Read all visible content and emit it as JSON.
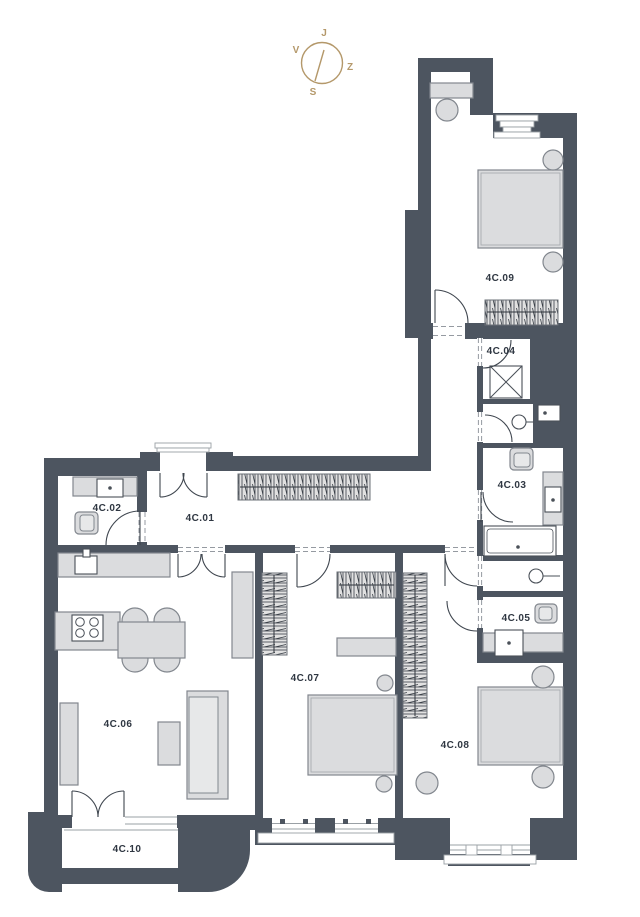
{
  "page": {
    "background": "#ffffff"
  },
  "compass": {
    "top": "J",
    "right": "Z",
    "bottom": "S",
    "left": "V"
  },
  "rooms": [
    {
      "label": "4C.01"
    },
    {
      "label": "4C.02"
    },
    {
      "label": "4C.03"
    },
    {
      "label": "4C.04"
    },
    {
      "label": "4C.05"
    },
    {
      "label": "4C.06"
    },
    {
      "label": "4C.07"
    },
    {
      "label": "4C.08"
    },
    {
      "label": "4C.09"
    },
    {
      "label": "4C.10"
    }
  ],
  "colors": {
    "wall": "#4d5560",
    "floor": "#ffffff",
    "furniture": "#dbdcde",
    "furniture_border": "#82878e",
    "line": "#3f464f",
    "hatch_bg": "#e1e1e1",
    "label": "#2f3742",
    "compass": "#b4986a",
    "frame": "#9aa0a5",
    "dash": "#959aa1"
  }
}
